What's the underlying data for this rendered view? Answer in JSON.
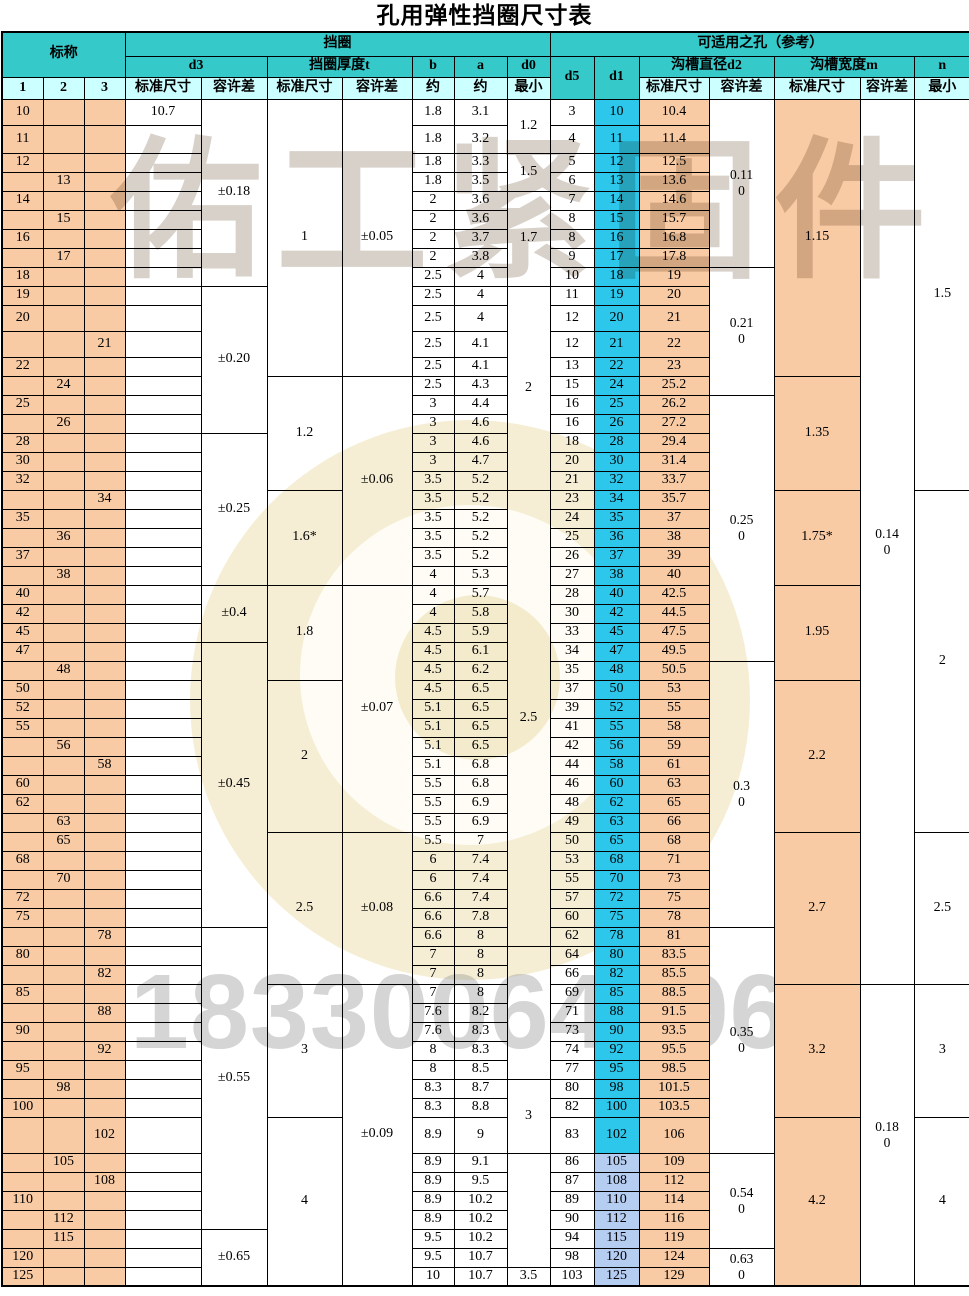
{
  "title": "孔用弹性挡圈尺寸表",
  "watermark": {
    "brand": "佑工紧固件",
    "phone": "18330064396"
  },
  "colors": {
    "header_teal": "#35C9C9",
    "header_pale_cyan": "#CCFFFF",
    "nominal_orange": "#F9CBA4",
    "d1_cyan": "#2CC7EB",
    "d1_light_blue": "#B6CDF2",
    "border": "#000000"
  },
  "header": {
    "row1": [
      {
        "t": "标称",
        "cs": 3,
        "rs": 2
      },
      {
        "t": "挡圈",
        "cs": 7,
        "rs": 1
      },
      {
        "t": "可适用之孔（参考）",
        "cs": 7,
        "rs": 1
      }
    ],
    "row2": [
      {
        "t": "d3",
        "cs": 2,
        "rs": 1
      },
      {
        "t": "挡圈厚度t",
        "cs": 2,
        "rs": 1
      },
      {
        "t": "b",
        "cs": 1,
        "rs": 1
      },
      {
        "t": "a",
        "cs": 1,
        "rs": 1
      },
      {
        "t": "d0",
        "cs": 1,
        "rs": 1
      },
      {
        "t": "d5",
        "cs": 1,
        "rs": 2
      },
      {
        "t": "d1",
        "cs": 1,
        "rs": 2
      },
      {
        "t": "沟槽直径d2",
        "cs": 2,
        "rs": 1
      },
      {
        "t": "沟槽宽度m",
        "cs": 2,
        "rs": 1
      },
      {
        "t": "n",
        "cs": 1,
        "rs": 1
      }
    ],
    "row3": [
      "1",
      "2",
      "3",
      "标准尺寸",
      "容许差",
      "标准尺寸",
      "容许差",
      "约",
      "约",
      "最小",
      "标准尺寸",
      "容许差",
      "标准尺寸",
      "容许差",
      "最小"
    ]
  },
  "rows": [
    [
      "10",
      "",
      "",
      "10.7",
      "1.8",
      "3.1",
      "3",
      "10",
      "10.4"
    ],
    [
      "11",
      "",
      "",
      "",
      "1.8",
      "3.2",
      "4",
      "11",
      "11.4"
    ],
    [
      "12",
      "",
      "",
      "",
      "1.8",
      "3.3",
      "5",
      "12",
      "12.5"
    ],
    [
      "",
      "13",
      "",
      "",
      "1.8",
      "3.5",
      "6",
      "13",
      "13.6"
    ],
    [
      "14",
      "",
      "",
      "",
      "2",
      "3.6",
      "7",
      "14",
      "14.6"
    ],
    [
      "",
      "15",
      "",
      "",
      "2",
      "3.6",
      "8",
      "15",
      "15.7"
    ],
    [
      "16",
      "",
      "",
      "",
      "2",
      "3.7",
      "8",
      "16",
      "16.8"
    ],
    [
      "",
      "17",
      "",
      "",
      "2",
      "3.8",
      "9",
      "17",
      "17.8"
    ],
    [
      "18",
      "",
      "",
      "",
      "2.5",
      "4",
      "10",
      "18",
      "19"
    ],
    [
      "19",
      "",
      "",
      "",
      "2.5",
      "4",
      "11",
      "19",
      "20"
    ],
    [
      "20",
      "",
      "",
      "",
      "2.5",
      "4",
      "12",
      "20",
      "21"
    ],
    [
      "",
      "",
      "21",
      "",
      "2.5",
      "4.1",
      "12",
      "21",
      "22"
    ],
    [
      "22",
      "",
      "",
      "",
      "2.5",
      "4.1",
      "13",
      "22",
      "23"
    ],
    [
      "",
      "24",
      "",
      "",
      "2.5",
      "4.3",
      "15",
      "24",
      "25.2"
    ],
    [
      "25",
      "",
      "",
      "",
      "3",
      "4.4",
      "16",
      "25",
      "26.2"
    ],
    [
      "",
      "26",
      "",
      "",
      "3",
      "4.6",
      "16",
      "26",
      "27.2"
    ],
    [
      "28",
      "",
      "",
      "",
      "3",
      "4.6",
      "18",
      "28",
      "29.4"
    ],
    [
      "30",
      "",
      "",
      "",
      "3",
      "4.7",
      "20",
      "30",
      "31.4"
    ],
    [
      "32",
      "",
      "",
      "",
      "3.5",
      "5.2",
      "21",
      "32",
      "33.7"
    ],
    [
      "",
      "",
      "34",
      "",
      "3.5",
      "5.2",
      "23",
      "34",
      "35.7"
    ],
    [
      "35",
      "",
      "",
      "",
      "3.5",
      "5.2",
      "24",
      "35",
      "37"
    ],
    [
      "",
      "36",
      "",
      "",
      "3.5",
      "5.2",
      "25",
      "36",
      "38"
    ],
    [
      "37",
      "",
      "",
      "",
      "3.5",
      "5.2",
      "26",
      "37",
      "39"
    ],
    [
      "",
      "38",
      "",
      "",
      "4",
      "5.3",
      "27",
      "38",
      "40"
    ],
    [
      "40",
      "",
      "",
      "",
      "4",
      "5.7",
      "28",
      "40",
      "42.5"
    ],
    [
      "42",
      "",
      "",
      "",
      "4",
      "5.8",
      "30",
      "42",
      "44.5"
    ],
    [
      "45",
      "",
      "",
      "",
      "4.5",
      "5.9",
      "33",
      "45",
      "47.5"
    ],
    [
      "47",
      "",
      "",
      "",
      "4.5",
      "6.1",
      "34",
      "47",
      "49.5"
    ],
    [
      "",
      "48",
      "",
      "",
      "4.5",
      "6.2",
      "35",
      "48",
      "50.5"
    ],
    [
      "50",
      "",
      "",
      "",
      "4.5",
      "6.5",
      "37",
      "50",
      "53"
    ],
    [
      "52",
      "",
      "",
      "",
      "5.1",
      "6.5",
      "39",
      "52",
      "55"
    ],
    [
      "55",
      "",
      "",
      "",
      "5.1",
      "6.5",
      "41",
      "55",
      "58"
    ],
    [
      "",
      "56",
      "",
      "",
      "5.1",
      "6.5",
      "42",
      "56",
      "59"
    ],
    [
      "",
      "",
      "58",
      "",
      "5.1",
      "6.8",
      "44",
      "58",
      "61"
    ],
    [
      "60",
      "",
      "",
      "",
      "5.5",
      "6.8",
      "46",
      "60",
      "63"
    ],
    [
      "62",
      "",
      "",
      "",
      "5.5",
      "6.9",
      "48",
      "62",
      "65"
    ],
    [
      "",
      "63",
      "",
      "",
      "5.5",
      "6.9",
      "49",
      "63",
      "66"
    ],
    [
      "",
      "65",
      "",
      "",
      "5.5",
      "7",
      "50",
      "65",
      "68"
    ],
    [
      "68",
      "",
      "",
      "",
      "6",
      "7.4",
      "53",
      "68",
      "71"
    ],
    [
      "",
      "70",
      "",
      "",
      "6",
      "7.4",
      "55",
      "70",
      "73"
    ],
    [
      "72",
      "",
      "",
      "",
      "6.6",
      "7.4",
      "57",
      "72",
      "75"
    ],
    [
      "75",
      "",
      "",
      "",
      "6.6",
      "7.8",
      "60",
      "75",
      "78"
    ],
    [
      "",
      "",
      "78",
      "",
      "6.6",
      "8",
      "62",
      "78",
      "81"
    ],
    [
      "80",
      "",
      "",
      "",
      "7",
      "8",
      "64",
      "80",
      "83.5"
    ],
    [
      "",
      "",
      "82",
      "",
      "7",
      "8",
      "66",
      "82",
      "85.5"
    ],
    [
      "85",
      "",
      "",
      "",
      "7",
      "8",
      "69",
      "85",
      "88.5"
    ],
    [
      "",
      "",
      "88",
      "",
      "7.6",
      "8.2",
      "71",
      "88",
      "91.5"
    ],
    [
      "90",
      "",
      "",
      "",
      "7.6",
      "8.3",
      "73",
      "90",
      "93.5"
    ],
    [
      "",
      "",
      "92",
      "",
      "8",
      "8.3",
      "74",
      "92",
      "95.5"
    ],
    [
      "95",
      "",
      "",
      "",
      "8",
      "8.5",
      "77",
      "95",
      "98.5"
    ],
    [
      "",
      "98",
      "",
      "",
      "8.3",
      "8.7",
      "80",
      "98",
      "101.5"
    ],
    [
      "100",
      "",
      "",
      "",
      "8.3",
      "8.8",
      "82",
      "100",
      "103.5"
    ],
    [
      "",
      "",
      "102",
      "",
      "8.9",
      "9",
      "83",
      "102",
      "106"
    ],
    [
      "",
      "105",
      "",
      "",
      "8.9",
      "9.1",
      "86",
      "105",
      "109"
    ],
    [
      "",
      "",
      "108",
      "",
      "8.9",
      "9.5",
      "87",
      "108",
      "112"
    ],
    [
      "110",
      "",
      "",
      "",
      "8.9",
      "10.2",
      "89",
      "110",
      "114"
    ],
    [
      "",
      "112",
      "",
      "",
      "8.9",
      "10.2",
      "90",
      "112",
      "116"
    ],
    [
      "",
      "115",
      "",
      "",
      "9.5",
      "10.2",
      "94",
      "115",
      "119"
    ],
    [
      "120",
      "",
      "",
      "",
      "9.5",
      "10.7",
      "98",
      "120",
      "124"
    ],
    [
      "125",
      "",
      "",
      "",
      "10",
      "10.7",
      "103",
      "125",
      "129"
    ]
  ],
  "merges": {
    "d3_tol": [
      [
        "±0.18",
        9
      ],
      [
        "±0.20",
        7
      ],
      [
        "±0.25",
        8
      ],
      [
        "±0.4",
        3
      ],
      [
        "±0.45",
        15
      ],
      [
        "±0.55",
        15
      ],
      [
        "±0.65",
        3
      ]
    ],
    "t_std": [
      [
        "1",
        13
      ],
      [
        "1.2",
        6
      ],
      [
        "1.6*",
        5
      ],
      [
        "1.8",
        5
      ],
      [
        "2",
        8
      ],
      [
        "2.5",
        8
      ],
      [
        "3",
        7
      ],
      [
        "4",
        8
      ]
    ],
    "t_tol": [
      [
        "±0.05",
        13
      ],
      [
        "±0.06",
        11
      ],
      [
        "±0.07",
        13
      ],
      [
        "±0.08",
        8
      ],
      [
        "±0.09",
        15
      ]
    ],
    "d0_min": [
      [
        "1.2",
        2
      ],
      [
        "1.5",
        2
      ],
      [
        "1.7",
        5
      ],
      [
        "2",
        10
      ],
      [
        "2.5",
        24
      ],
      [
        "",
        7
      ],
      [
        "3",
        3
      ],
      [
        "",
        6
      ],
      [
        "3.5",
        1
      ]
    ],
    "d2_tol": [
      [
        "0.11\n0",
        8
      ],
      [
        "0.21\n0",
        6
      ],
      [
        "0.25\n0",
        14
      ],
      [
        "0.3\n0",
        14
      ],
      [
        "0.35\n0",
        11
      ],
      [
        "0.54\n0",
        5
      ],
      [
        "0.63\n0",
        2
      ]
    ],
    "m_std": [
      [
        "1.15",
        13
      ],
      [
        "1.35",
        6
      ],
      [
        "1.75*",
        5
      ],
      [
        "1.95",
        5
      ],
      [
        "2.2",
        8
      ],
      [
        "2.7",
        8
      ],
      [
        "3.2",
        7
      ],
      [
        "4.2",
        8
      ]
    ],
    "m_tol": [
      [
        "0.14\n0",
        45
      ],
      [
        "0.18\n0",
        15
      ]
    ],
    "n_min": [
      [
        "1.5",
        19
      ],
      [
        "2",
        18
      ],
      [
        "2.5",
        8
      ],
      [
        "3",
        7
      ],
      [
        "4",
        8
      ]
    ]
  },
  "row_heights": {
    "0": 26,
    "1": 28,
    "10": 26,
    "11": 26,
    "52": 36
  },
  "default_row_height": 19,
  "d1_light_blue_from_index": 53
}
